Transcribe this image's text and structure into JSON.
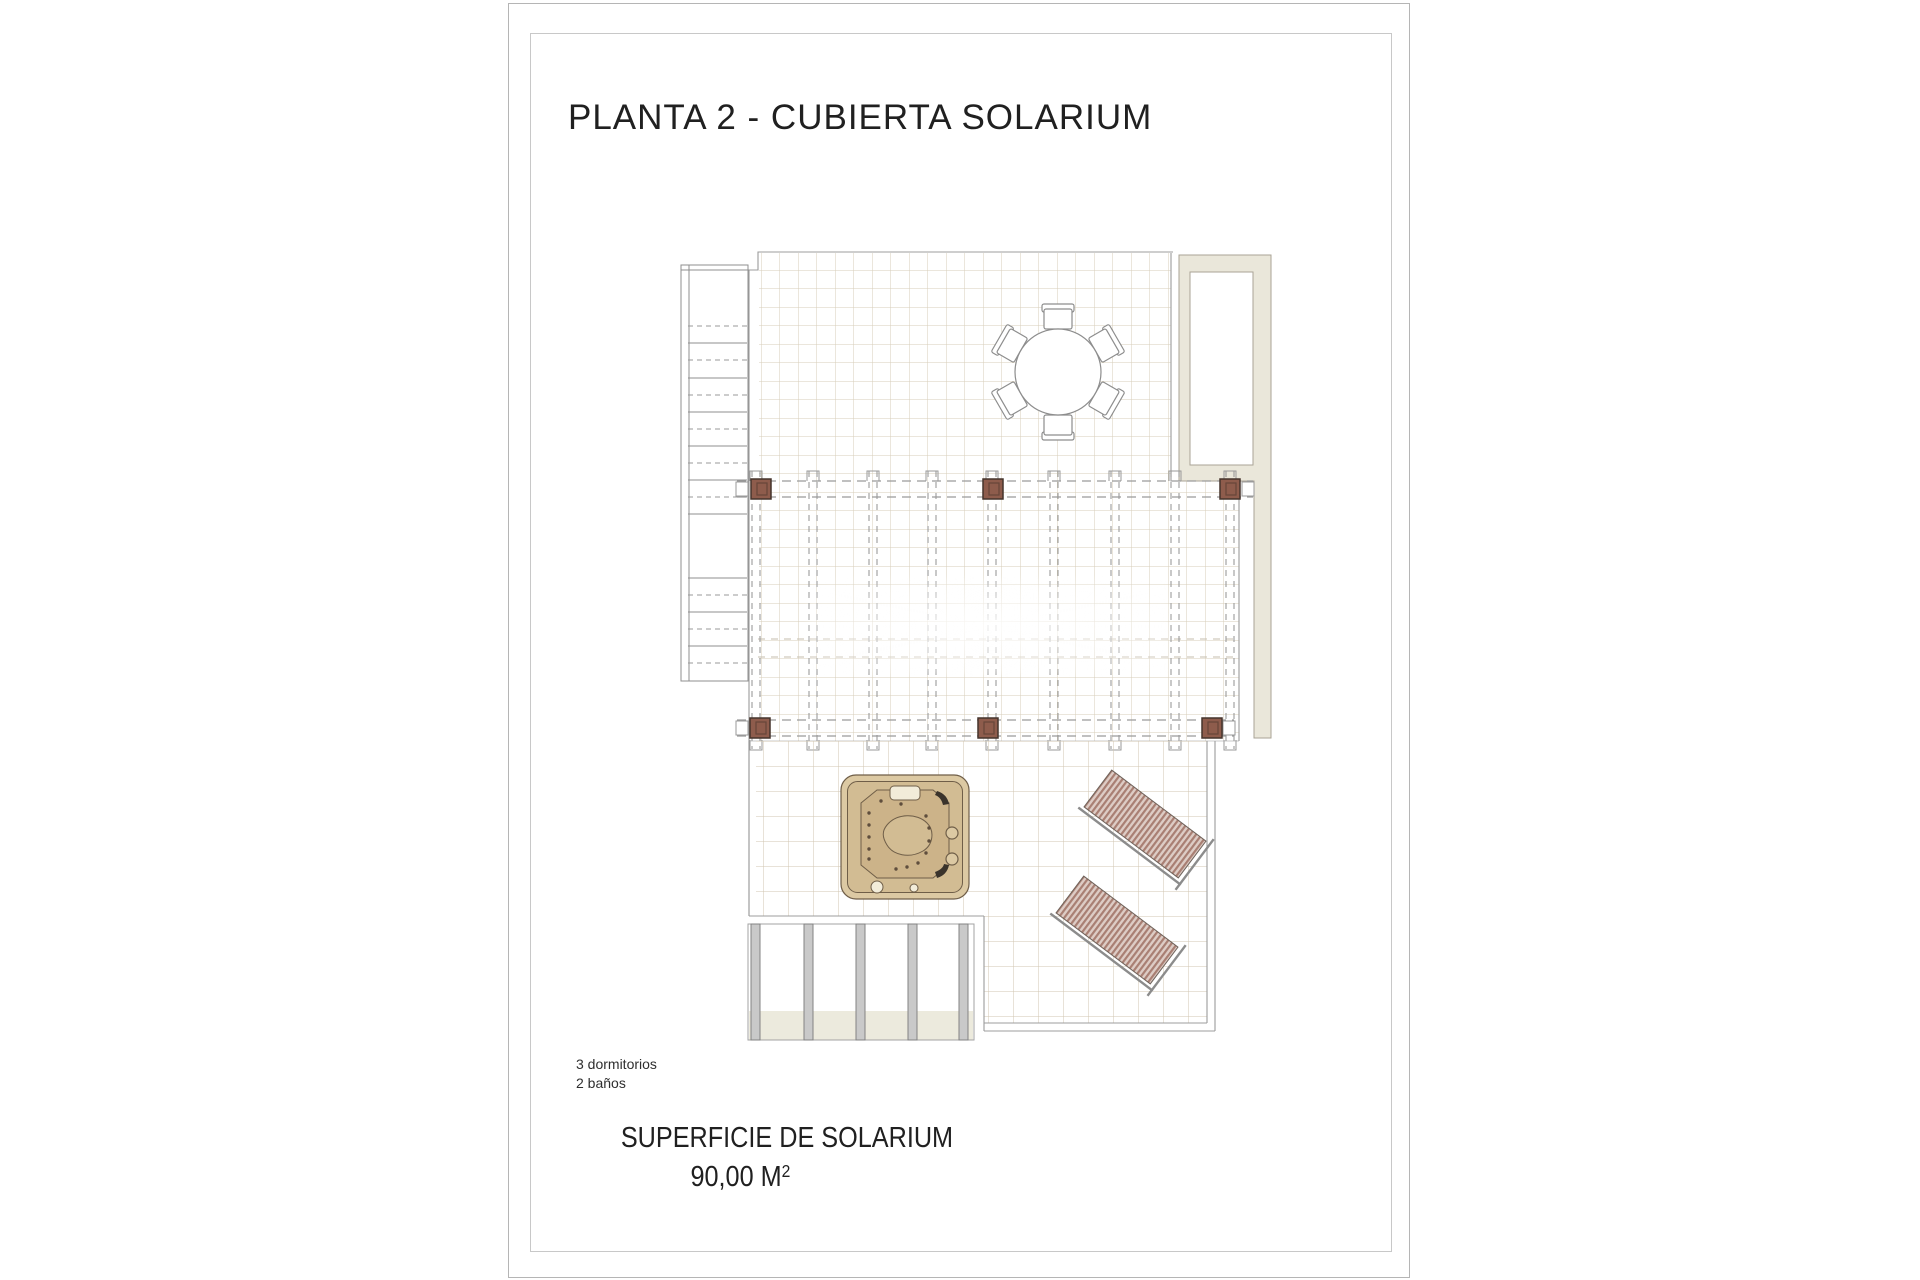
{
  "page": {
    "title": "PLANTA 2 - CUBIERTA SOLARIUM"
  },
  "info": {
    "bedrooms": "3 dormitorios",
    "bathrooms": "2 baños"
  },
  "area": {
    "label": "SUPERFICIE DE SOLARIUM",
    "value": "90,00 M",
    "sup": "2"
  },
  "colors": {
    "pageb": "#b5b5b5",
    "frameb": "#c8c8c8",
    "text": "#202020",
    "tile": "#d7ceba",
    "tile2": "#d0c6b0",
    "outline": "#9c9c9c",
    "dash": "#9a9a9a",
    "midline": "#c6bdad",
    "stair": "#8f8f8f",
    "post": "#8e5c4c",
    "postb": "#45342c",
    "wall": "#eae7da",
    "wallb": "#a9a395",
    "furn": "#8d8d8d",
    "jrim": "#dcc9a3",
    "jmid": "#d2bc93",
    "jbasin": "#ccb389",
    "jline": "#6f5e48",
    "jdot": "#5f4e3d",
    "column": "#c9c9c9",
    "band": "#eceadd",
    "loud": "#a97f73",
    "loul": "#ddccc5",
    "lframe": "#8c8c8c"
  }
}
